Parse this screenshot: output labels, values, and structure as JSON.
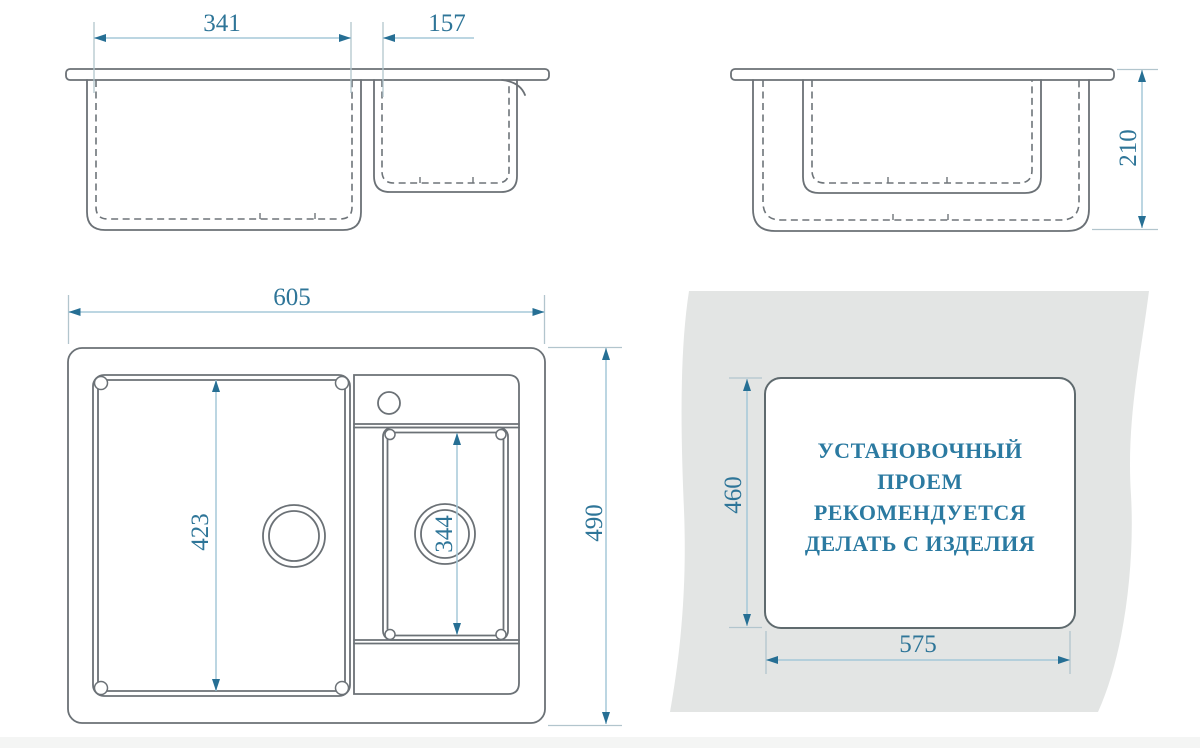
{
  "drawing_title": "sink-dimension-drawing",
  "front_view": {
    "main_bowl_width": "341",
    "small_bowl_width": "157"
  },
  "side_view": {
    "bowl_depth": "210"
  },
  "top_view": {
    "overall_width": "605",
    "overall_depth": "490",
    "main_bowl_length": "423",
    "small_bowl_length": "344"
  },
  "installation_view": {
    "cutout_depth": "460",
    "cutout_width": "575",
    "note": [
      "УСТАНОВОЧНЫЙ",
      "ПРОЕМ",
      "РЕКОМЕНДУЕТСЯ",
      "ДЕЛАТЬ С ИЗДЕЛИЯ"
    ]
  },
  "colors": {
    "drawing_line": "#6b7176",
    "dimension_line": "#a5c8d8",
    "extension_line": "#b2c5cd",
    "arrow": "#266f94",
    "dimension_text": "#2e7598",
    "note_text": "#2b7aa1",
    "countertop_fill": "#e3e5e4"
  }
}
